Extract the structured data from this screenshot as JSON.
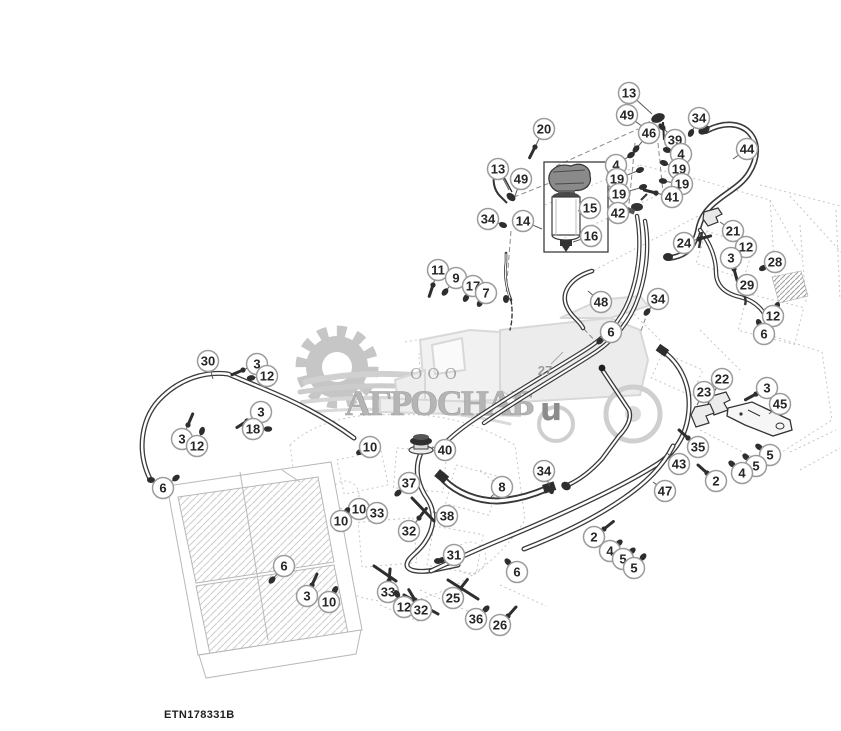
{
  "page": {
    "width": 841,
    "height": 731,
    "background": "#ffffff",
    "type": "parts-diagram"
  },
  "figure": {
    "id_label": "ETN178331B"
  },
  "watermark": {
    "prefix": "ООО",
    "company": "АГРОСНАБ",
    "tail_letter": "u",
    "text_color": "#b5b5b5",
    "accent_gray": "#c6c6c6"
  },
  "callout_style": {
    "circle_fill": "#ffffff",
    "circle_stroke": "#9b9b9b",
    "number_color": "#262626",
    "leader_color": "#5a5a5a",
    "part_color": "#2e2e2e",
    "radius": 10.5
  },
  "callouts": [
    {
      "n": "13",
      "x": 629,
      "y": 93,
      "tx": 652,
      "ty": 114,
      "t": ""
    },
    {
      "n": "49",
      "x": 627,
      "y": 115,
      "tx": 643,
      "ty": 127,
      "t": ""
    },
    {
      "n": "20",
      "x": 544,
      "y": 129,
      "tx": 535,
      "ty": 147,
      "t": "r"
    },
    {
      "n": "46",
      "x": 649,
      "y": 133,
      "tx": 636,
      "ty": 149,
      "t": "b"
    },
    {
      "n": "34",
      "x": 699,
      "y": 118,
      "tx": 691,
      "ty": 133,
      "t": "b"
    },
    {
      "n": "39",
      "x": 675,
      "y": 140,
      "tx": 662,
      "ty": 127,
      "t": "b"
    },
    {
      "n": "44",
      "x": 747,
      "y": 149,
      "tx": 733,
      "ty": 159,
      "t": ""
    },
    {
      "n": "4",
      "x": 681,
      "y": 154,
      "tx": 667,
      "ty": 150,
      "t": "b"
    },
    {
      "n": "19",
      "x": 679,
      "y": 169,
      "tx": 664,
      "ty": 163,
      "t": "b"
    },
    {
      "n": "19",
      "x": 682,
      "y": 184,
      "tx": 663,
      "ty": 181,
      "t": "b"
    },
    {
      "n": "4",
      "x": 616,
      "y": 165,
      "tx": 631,
      "ty": 155,
      "t": "b"
    },
    {
      "n": "19",
      "x": 617,
      "y": 179,
      "tx": 640,
      "ty": 170,
      "t": "b"
    },
    {
      "n": "19",
      "x": 619,
      "y": 194,
      "tx": 643,
      "ty": 187,
      "t": "b"
    },
    {
      "n": "41",
      "x": 672,
      "y": 197,
      "tx": 656,
      "ty": 193,
      "t": "r"
    },
    {
      "n": "42",
      "x": 618,
      "y": 213,
      "tx": 633,
      "ty": 209,
      "t": ""
    },
    {
      "n": "13",
      "x": 498,
      "y": 169,
      "tx": 509,
      "ty": 190,
      "t": ""
    },
    {
      "n": "49",
      "x": 521,
      "y": 179,
      "tx": 515,
      "ty": 196,
      "t": ""
    },
    {
      "n": "34",
      "x": 488,
      "y": 219,
      "tx": 503,
      "ty": 225,
      "t": "b"
    },
    {
      "n": "14",
      "x": 523,
      "y": 221,
      "tx": 542,
      "ty": 229,
      "t": ""
    },
    {
      "n": "15",
      "x": 590,
      "y": 208,
      "tx": 578,
      "ty": 211,
      "t": ""
    },
    {
      "n": "16",
      "x": 591,
      "y": 236,
      "tx": 573,
      "ty": 242,
      "t": ""
    },
    {
      "n": "21",
      "x": 733,
      "y": 231,
      "tx": 720,
      "ty": 222,
      "t": ""
    },
    {
      "n": "24",
      "x": 684,
      "y": 243,
      "tx": 699,
      "ty": 239,
      "t": "r"
    },
    {
      "n": "12",
      "x": 746,
      "y": 247,
      "tx": 737,
      "ty": 257,
      "t": "b"
    },
    {
      "n": "3",
      "x": 731,
      "y": 258,
      "tx": 734,
      "ty": 269,
      "t": "r"
    },
    {
      "n": "28",
      "x": 775,
      "y": 262,
      "tx": 763,
      "ty": 268,
      "t": "b"
    },
    {
      "n": "29",
      "x": 747,
      "y": 285,
      "tx": 742,
      "ty": 295,
      "t": ""
    },
    {
      "n": "34",
      "x": 658,
      "y": 299,
      "tx": 647,
      "ty": 312,
      "t": "b"
    },
    {
      "n": "12",
      "x": 773,
      "y": 316,
      "tx": 777,
      "ty": 306,
      "t": "b"
    },
    {
      "n": "6",
      "x": 764,
      "y": 334,
      "tx": 759,
      "ty": 323,
      "t": "b"
    },
    {
      "n": "48",
      "x": 601,
      "y": 302,
      "tx": 588,
      "ty": 291,
      "t": ""
    },
    {
      "n": "6",
      "x": 611,
      "y": 332,
      "tx": 600,
      "ty": 341,
      "t": "b"
    },
    {
      "n": "11",
      "x": 438,
      "y": 270,
      "tx": 433,
      "ty": 285,
      "t": "r"
    },
    {
      "n": "9",
      "x": 456,
      "y": 278,
      "tx": 445,
      "ty": 292,
      "t": "b"
    },
    {
      "n": "17",
      "x": 473,
      "y": 286,
      "tx": 466,
      "ty": 298,
      "t": "b"
    },
    {
      "n": "7",
      "x": 486,
      "y": 293,
      "tx": 480,
      "ty": 303,
      "t": "b"
    },
    {
      "n": "30",
      "x": 208,
      "y": 361,
      "tx": 213,
      "ty": 379,
      "t": ""
    },
    {
      "n": "3",
      "x": 257,
      "y": 364,
      "tx": 243,
      "ty": 370,
      "t": "r"
    },
    {
      "n": "12",
      "x": 267,
      "y": 376,
      "tx": 251,
      "ty": 378,
      "t": "b"
    },
    {
      "n": "3",
      "x": 261,
      "y": 412,
      "tx": 247,
      "ty": 421,
      "t": "r"
    },
    {
      "n": "18",
      "x": 253,
      "y": 429,
      "tx": 268,
      "ty": 429,
      "t": "b"
    },
    {
      "n": "3",
      "x": 182,
      "y": 439,
      "tx": 188,
      "ty": 425,
      "t": "r"
    },
    {
      "n": "12",
      "x": 197,
      "y": 446,
      "tx": 202,
      "ty": 431,
      "t": "b"
    },
    {
      "n": "6",
      "x": 163,
      "y": 488,
      "tx": 176,
      "ty": 478,
      "t": "b"
    },
    {
      "n": "22",
      "x": 722,
      "y": 379,
      "tx": 714,
      "ty": 392,
      "t": ""
    },
    {
      "n": "23",
      "x": 704,
      "y": 392,
      "tx": 697,
      "ty": 405,
      "t": ""
    },
    {
      "n": "3",
      "x": 767,
      "y": 388,
      "tx": 756,
      "ty": 394,
      "t": "r"
    },
    {
      "n": "45",
      "x": 780,
      "y": 404,
      "tx": 769,
      "ty": 414,
      "t": ""
    },
    {
      "n": "35",
      "x": 698,
      "y": 447,
      "tx": 688,
      "ty": 438,
      "t": "r"
    },
    {
      "n": "43",
      "x": 679,
      "y": 464,
      "tx": 667,
      "ty": 453,
      "t": ""
    },
    {
      "n": "47",
      "x": 665,
      "y": 491,
      "tx": 653,
      "ty": 482,
      "t": ""
    },
    {
      "n": "5",
      "x": 770,
      "y": 455,
      "tx": 759,
      "ty": 447,
      "t": "b"
    },
    {
      "n": "5",
      "x": 756,
      "y": 466,
      "tx": 746,
      "ty": 457,
      "t": "b"
    },
    {
      "n": "4",
      "x": 742,
      "y": 473,
      "tx": 732,
      "ty": 464,
      "t": "b"
    },
    {
      "n": "2",
      "x": 716,
      "y": 481,
      "tx": 707,
      "ty": 473,
      "t": "r"
    },
    {
      "n": "10",
      "x": 370,
      "y": 447,
      "tx": 360,
      "ty": 452,
      "t": "b"
    },
    {
      "n": "40",
      "x": 445,
      "y": 450,
      "tx": 432,
      "ty": 447,
      "t": ""
    },
    {
      "n": "37",
      "x": 409,
      "y": 483,
      "tx": 398,
      "ty": 493,
      "t": "b"
    },
    {
      "n": "8",
      "x": 502,
      "y": 487,
      "tx": 491,
      "ty": 497,
      "t": ""
    },
    {
      "n": "34",
      "x": 544,
      "y": 471,
      "tx": 551,
      "ty": 490,
      "t": "b"
    },
    {
      "n": "10",
      "x": 359,
      "y": 509,
      "tx": 349,
      "ty": 515,
      "t": "b"
    },
    {
      "n": "33",
      "x": 377,
      "y": 513,
      "tx": 382,
      "ty": 503,
      "t": ""
    },
    {
      "n": "10",
      "x": 341,
      "y": 521,
      "tx": 347,
      "ty": 511,
      "t": "b"
    },
    {
      "n": "32",
      "x": 409,
      "y": 531,
      "tx": 419,
      "ty": 518,
      "t": "r"
    },
    {
      "n": "38",
      "x": 447,
      "y": 516,
      "tx": 433,
      "ty": 512,
      "t": ""
    },
    {
      "n": "31",
      "x": 454,
      "y": 555,
      "tx": 442,
      "ty": 560,
      "t": "b"
    },
    {
      "n": "6",
      "x": 517,
      "y": 572,
      "tx": 508,
      "ty": 562,
      "t": "b"
    },
    {
      "n": "6",
      "x": 284,
      "y": 566,
      "tx": 272,
      "ty": 580,
      "t": "b"
    },
    {
      "n": "3",
      "x": 307,
      "y": 596,
      "tx": 312,
      "ty": 585,
      "t": "r"
    },
    {
      "n": "10",
      "x": 329,
      "y": 602,
      "tx": 335,
      "ty": 590,
      "t": "b"
    },
    {
      "n": "33",
      "x": 388,
      "y": 592,
      "tx": 389,
      "ty": 581,
      "t": "r"
    },
    {
      "n": "25",
      "x": 453,
      "y": 598,
      "tx": 460,
      "ty": 589,
      "t": "r"
    },
    {
      "n": "12",
      "x": 404,
      "y": 607,
      "tx": 397,
      "ty": 594,
      "t": "b"
    },
    {
      "n": "32",
      "x": 421,
      "y": 610,
      "tx": 415,
      "ty": 600,
      "t": "r"
    },
    {
      "n": "36",
      "x": 476,
      "y": 619,
      "tx": 486,
      "ty": 609,
      "t": "b"
    },
    {
      "n": "26",
      "x": 500,
      "y": 625,
      "tx": 508,
      "ty": 616,
      "t": "r"
    },
    {
      "n": "2",
      "x": 594,
      "y": 537,
      "tx": 604,
      "ty": 529,
      "t": "r"
    },
    {
      "n": "4",
      "x": 610,
      "y": 551,
      "tx": 619,
      "ty": 543,
      "t": "b"
    },
    {
      "n": "5",
      "x": 623,
      "y": 559,
      "tx": 632,
      "ty": 551,
      "t": "b"
    },
    {
      "n": "5",
      "x": 634,
      "y": 568,
      "tx": 643,
      "ty": 557,
      "t": "b"
    }
  ],
  "plain_labels": [
    {
      "text": "27",
      "x": 545,
      "y": 375,
      "color": "#9c9c9c",
      "lx1": 551,
      "ly1": 364,
      "lx2": 563,
      "ly2": 352
    }
  ]
}
